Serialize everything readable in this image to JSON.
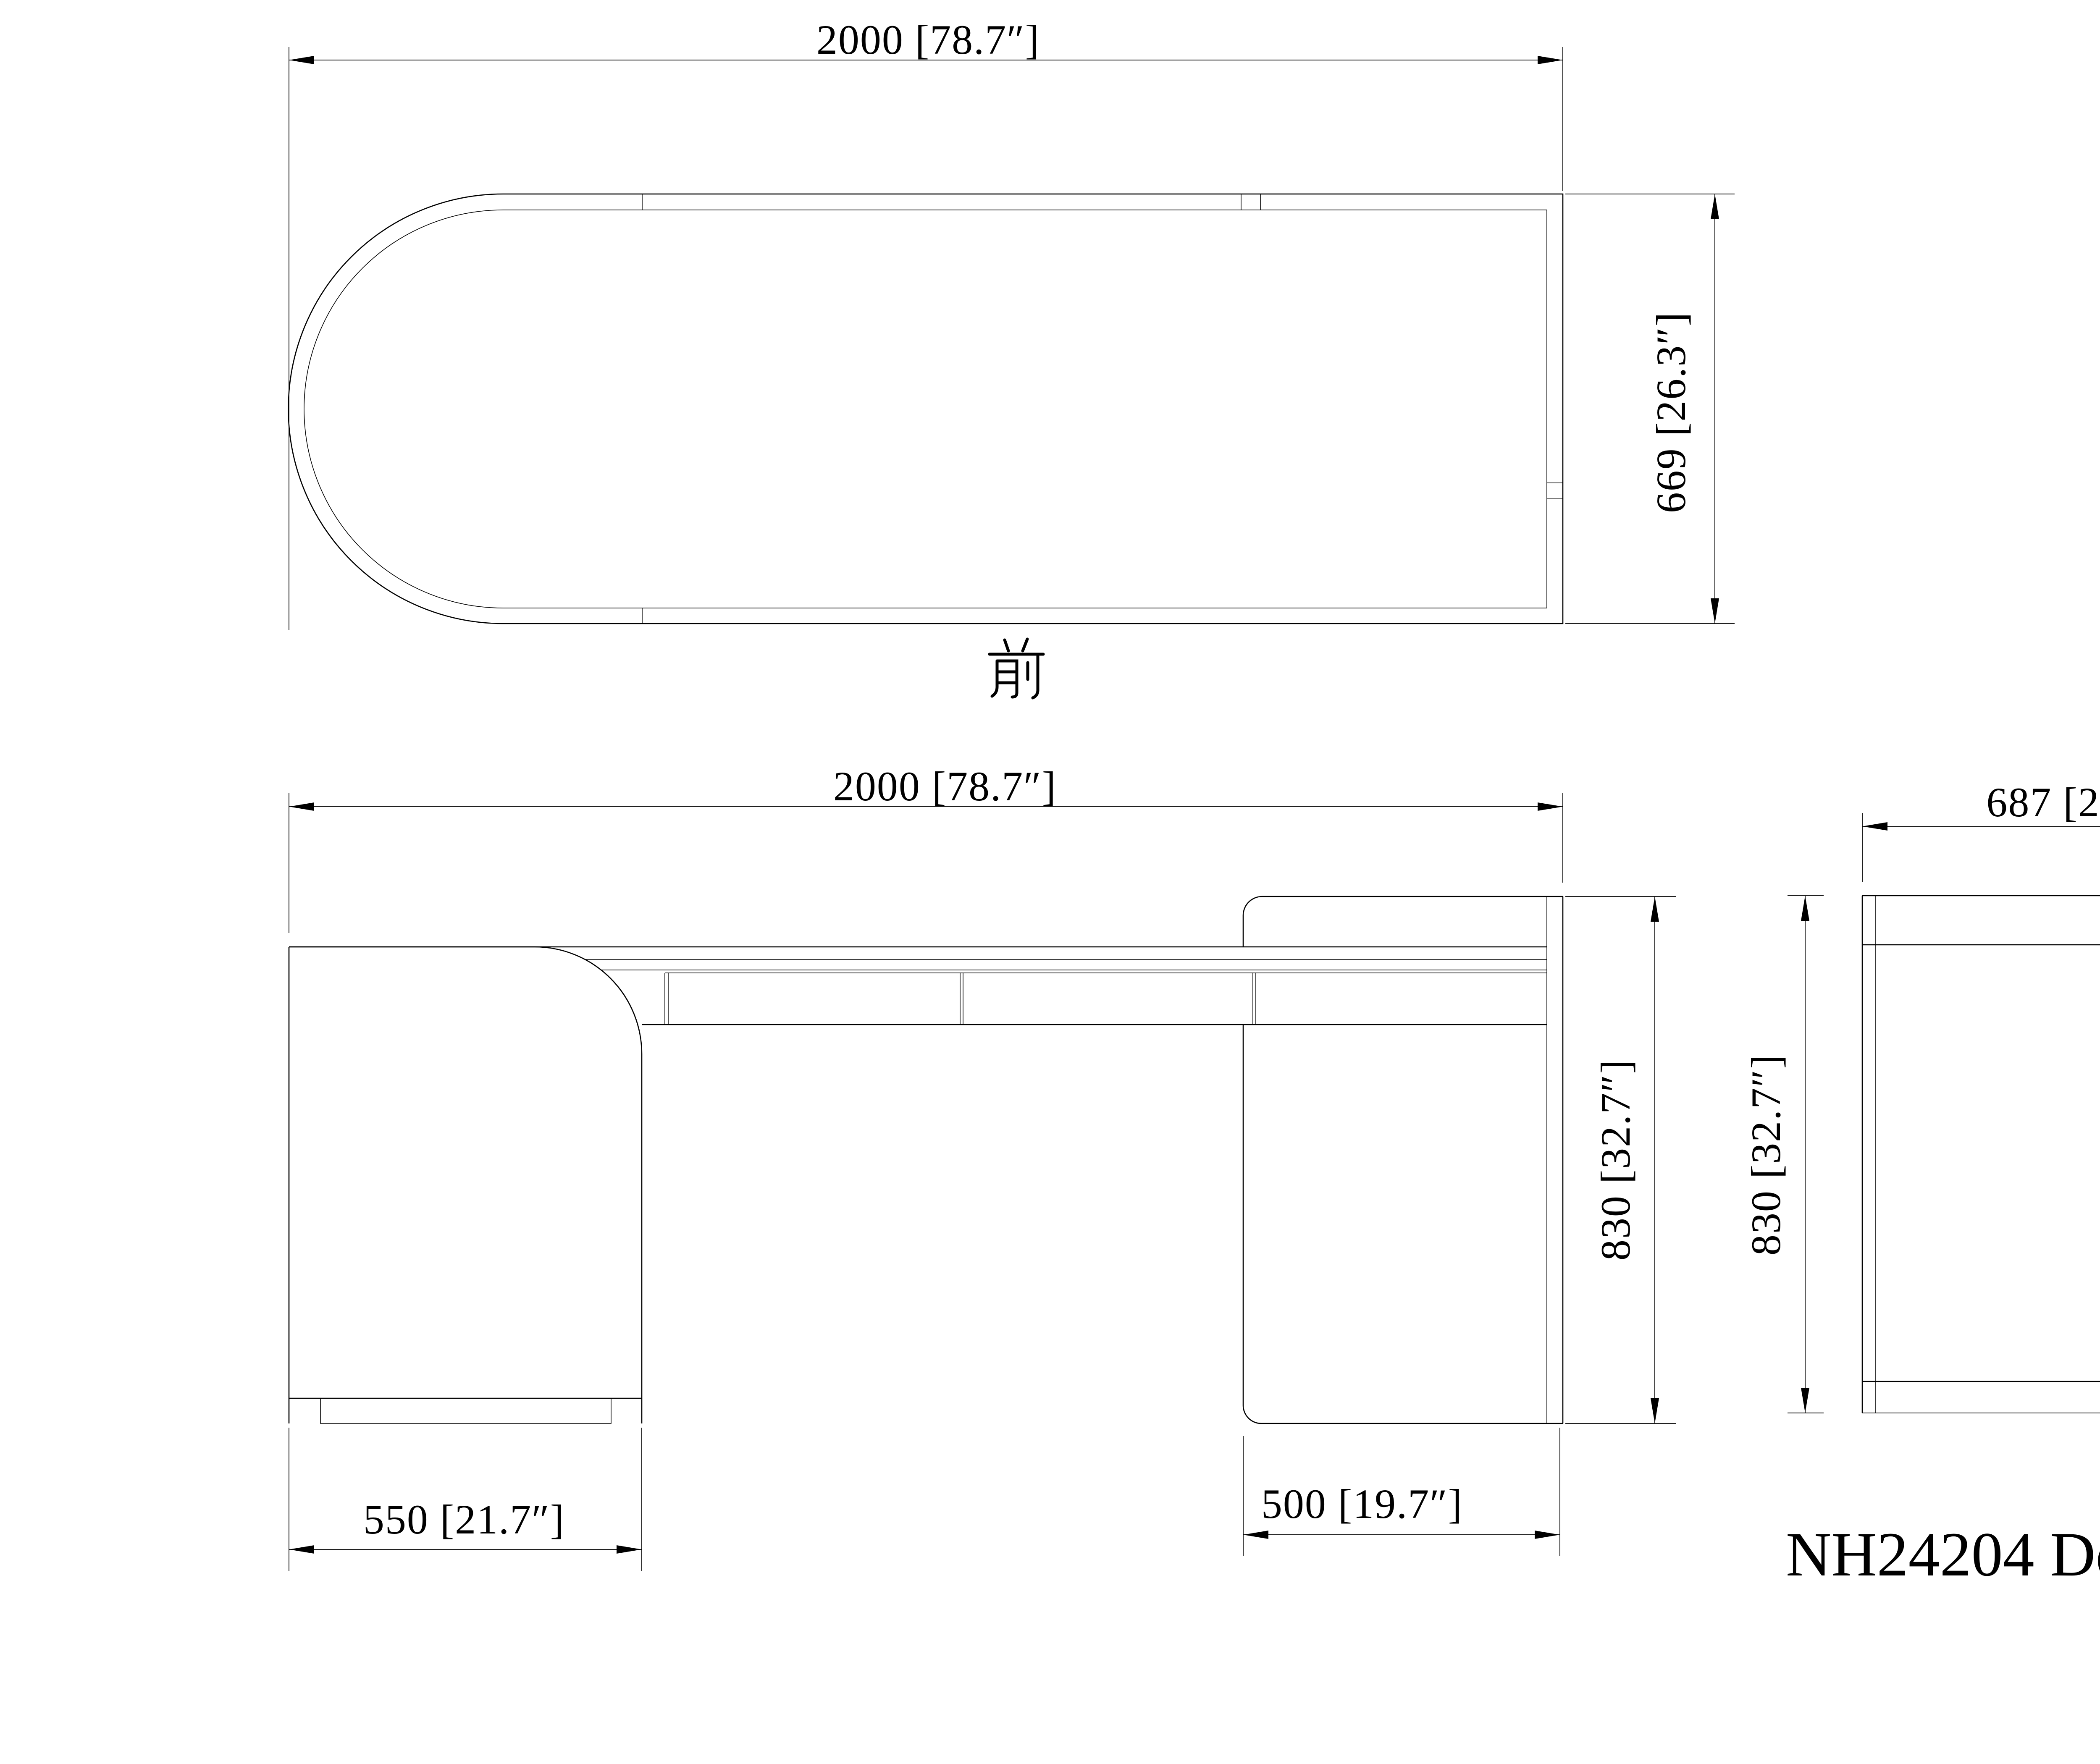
{
  "drawing_title": "NH24204 Desk",
  "colors": {
    "line": "#000000",
    "background": "#ffffff"
  },
  "views": {
    "top": {
      "name": "plan view",
      "front_label": "前",
      "width_dim": "2000 [78.7″]",
      "depth_dim": "669 [26.3″]",
      "width_mm": 2000,
      "depth_mm": 669
    },
    "front": {
      "name": "front elevation",
      "width_dim": "2000 [78.7″]",
      "height_dim": "830 [32.7″]",
      "left_pedestal_dim": "550 [21.7″]",
      "right_pedestal_dim": "500 [19.7″]",
      "width_mm": 2000,
      "height_mm": 830,
      "left_pedestal_mm": 550,
      "right_pedestal_mm": 500
    },
    "side": {
      "name": "side elevation",
      "width_dim": "687 [27″]",
      "height_dim": "830 [32.7″]",
      "width_mm": 687,
      "height_mm": 830
    }
  }
}
